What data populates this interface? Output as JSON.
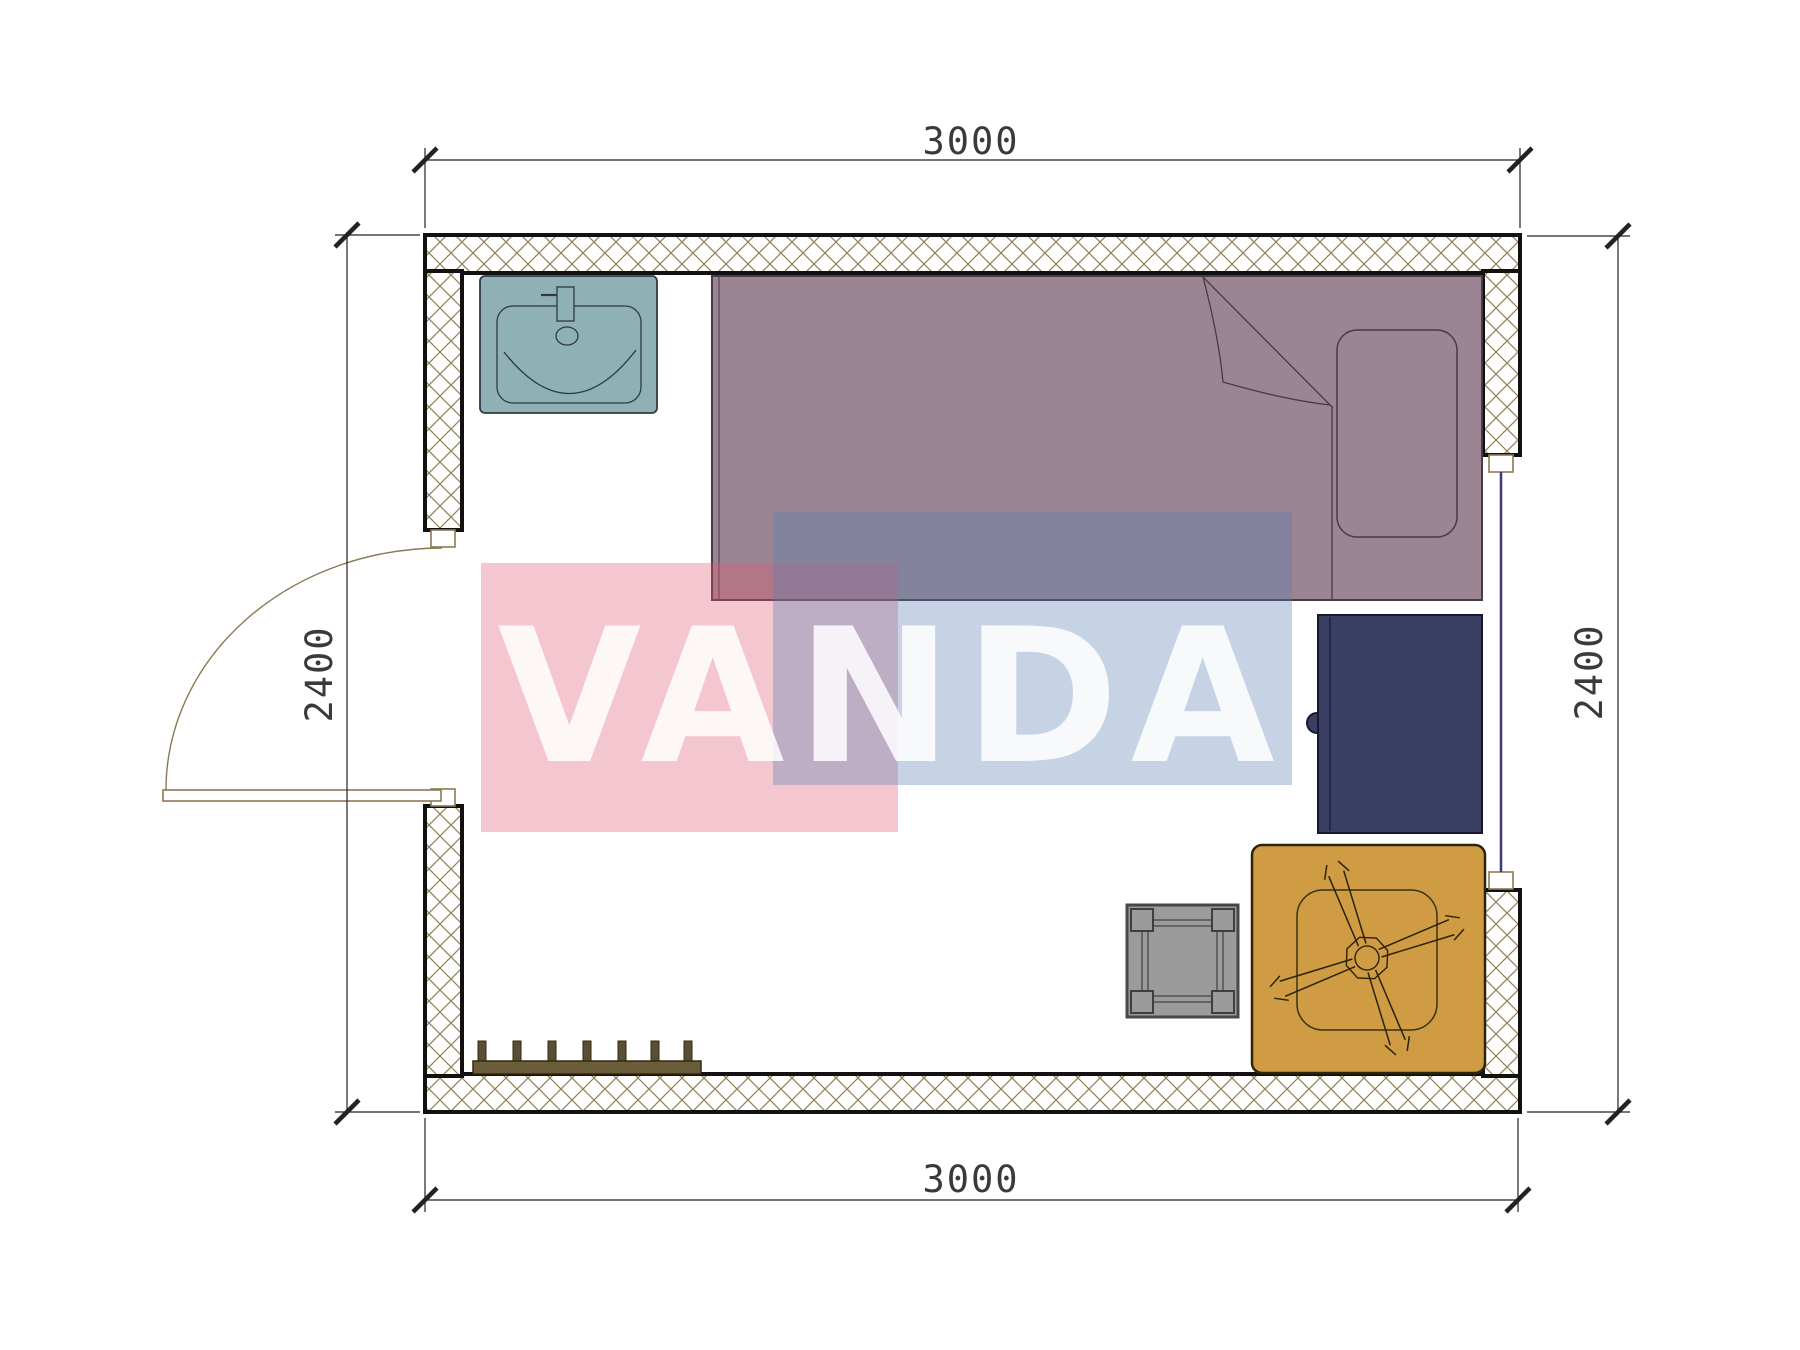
{
  "dimensions": {
    "top": "3000",
    "bottom": "3000",
    "left": "2400",
    "right": "2400"
  },
  "watermark": {
    "text": "VANDA",
    "pink_color": "#df5c79",
    "blue_color": "#5981b2",
    "text_color": "#ffffff"
  },
  "colors": {
    "wall_outline": "#111111",
    "wall_hatch": "#8f7f55",
    "sink": "#8fb1b6",
    "bed": "#9b8593",
    "desk": "#3a3e63",
    "table": "#cf9c44",
    "stool": "#9b9b9b",
    "coat_rack": "#6b5d39",
    "window_glazing": "#3b3b7e",
    "door": "#8a7a52",
    "dimension_text": "#3a3a3a"
  },
  "furniture_icons": [
    "sink-icon",
    "single-bed-icon",
    "pillow-icon",
    "desk-cabinet-icon",
    "table-with-fan-icon",
    "stool-icon",
    "coat-rack-icon",
    "door-swing-icon",
    "window-icon"
  ]
}
